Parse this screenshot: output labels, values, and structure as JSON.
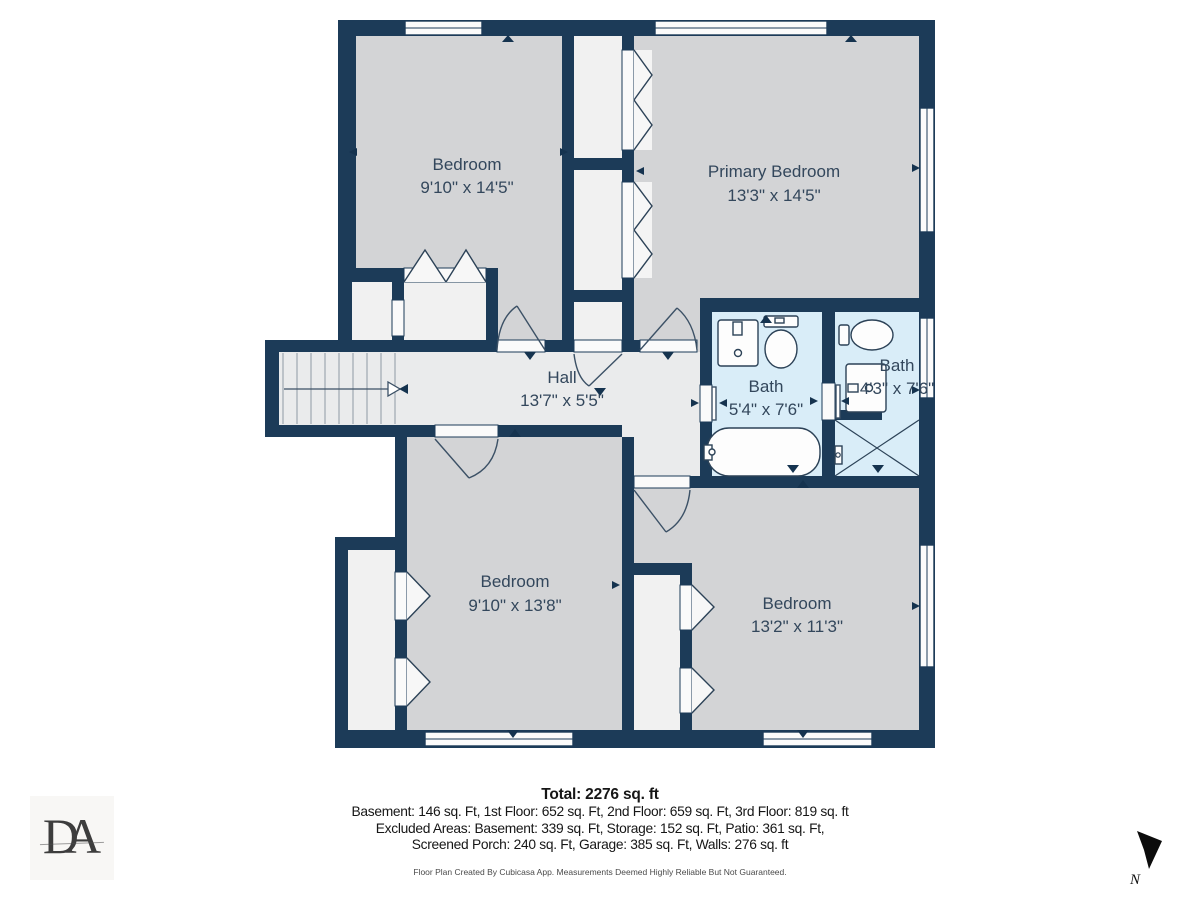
{
  "plan": {
    "rooms": [
      {
        "name": "Bedroom",
        "dims": "9'10\" x 14'5\""
      },
      {
        "name": "Primary Bedroom",
        "dims": "13'3\" x 14'5\""
      },
      {
        "name": "Hall",
        "dims": "13'7\" x 5'5\""
      },
      {
        "name": "Bath",
        "dims": "5'4\" x 7'6\""
      },
      {
        "name": "Bath",
        "dims": "4'3\" x 7'6\""
      },
      {
        "name": "Bedroom",
        "dims": "9'10\" x 13'8\""
      },
      {
        "name": "Bedroom",
        "dims": "13'2\" x 11'3\""
      }
    ],
    "compass_label": "N"
  },
  "footer": {
    "total": "Total: 2276 sq. ft",
    "line1": "Basement: 146 sq. Ft, 1st Floor: 652 sq. Ft, 2nd Floor: 659 sq. Ft, 3rd Floor: 819 sq. ft",
    "line2": "Excluded Areas: Basement: 339 sq. Ft, Storage: 152 sq. Ft, Patio: 361 sq. Ft,",
    "line3": "Screened Porch: 240 sq. Ft, Garage: 385 sq. Ft, Walls: 276 sq. ft",
    "disclaimer": "Floor Plan Created By Cubicasa App. Measurements Deemed Highly Reliable But Not Guaranteed."
  },
  "logo": {
    "monogram": "DA"
  },
  "colors": {
    "wall": "#1c3b58",
    "room_gray": "#d3d4d6",
    "hall_gray": "#eaebec",
    "closet_white": "#f1f1f1",
    "bath_blue": "#d9edf8",
    "label_text": "#33475c",
    "marker": "#15334f"
  }
}
